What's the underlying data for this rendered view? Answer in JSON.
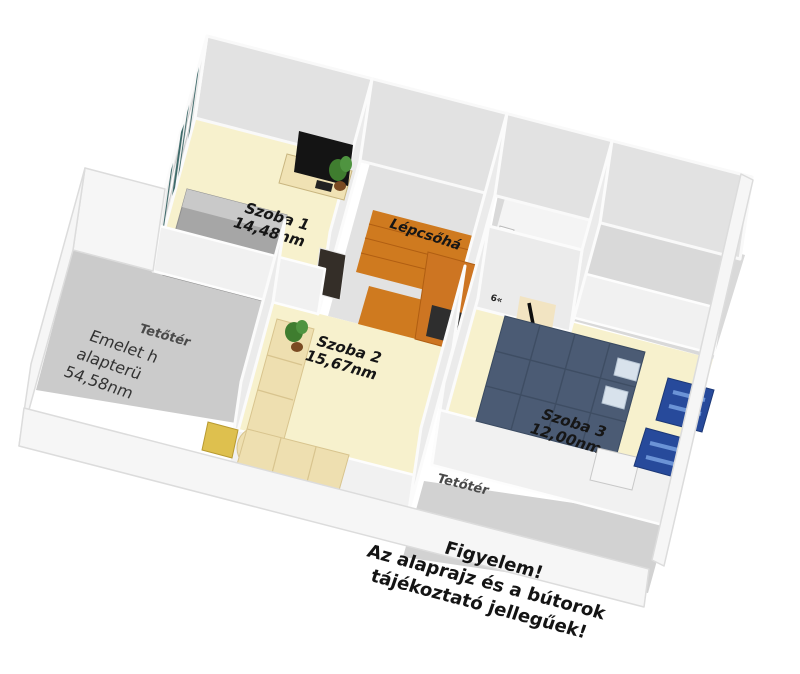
{
  "rooms": {
    "room1": {
      "name": "Szoba 1",
      "area": "14,48nm"
    },
    "room2": {
      "name": "Szoba 2",
      "area": "15,67nm"
    },
    "room3": {
      "name": "Szoba 3",
      "area": "12,00nm"
    },
    "staircase": {
      "name": "Lépcsőhá"
    },
    "attic_left": {
      "name": "Tetőtér"
    },
    "attic_front": {
      "name": "Tetőtér"
    },
    "bath_partial_label": "6«"
  },
  "annotations": {
    "floor_info": {
      "line1": "Emelet h",
      "line2": "alapterü",
      "line3": "54,58nm"
    },
    "disclaimer": {
      "line1": "Figyelem!",
      "line2": "Az alaprajz és a bútorok",
      "line3": "tájékoztató jellegűek!"
    }
  },
  "colors": {
    "background": "#ffffff",
    "wall_face": "#ebebeb",
    "wall_back": "#e2e2e2",
    "floor_room_yellow": "#f7f1cd",
    "floor_attic_gray": "#cccccc",
    "floor_stairs_orange": "#cf7a1f",
    "curtain_teal": "#3f6b6b",
    "sofa_cream": "#eedfb0",
    "bed_gray": "#a6a6a6",
    "bed_blue": "#4b5b74",
    "shelf_blue": "#274a9b",
    "armchair_orange": "#cd7522",
    "label_text": "#161616"
  },
  "furniture": [
    {
      "name": "double-bed-gray",
      "room": "Szoba 1"
    },
    {
      "name": "tv-stand",
      "room": "Szoba 1"
    },
    {
      "name": "flat-tv",
      "room": "Szoba 1"
    },
    {
      "name": "potted-plant",
      "room": "Szoba 1"
    },
    {
      "name": "window-curtains",
      "room": "Szoba 1"
    },
    {
      "name": "staircase",
      "room": "Lépcsőhá"
    },
    {
      "name": "armchair-orange",
      "room": "hall"
    },
    {
      "name": "toilet",
      "room": "bathroom"
    },
    {
      "name": "sink",
      "room": "bathroom"
    },
    {
      "name": "corner-sofa",
      "room": "Szoba 2"
    },
    {
      "name": "side-table",
      "room": "Szoba 2"
    },
    {
      "name": "potted-plant",
      "room": "Szoba 2"
    },
    {
      "name": "double-bed-blue",
      "room": "Szoba 3"
    },
    {
      "name": "guitar",
      "room": "Szoba 3"
    },
    {
      "name": "shelf-unit-blue",
      "room": "Szoba 3"
    },
    {
      "name": "bench-white",
      "room": "Szoba 3"
    }
  ]
}
